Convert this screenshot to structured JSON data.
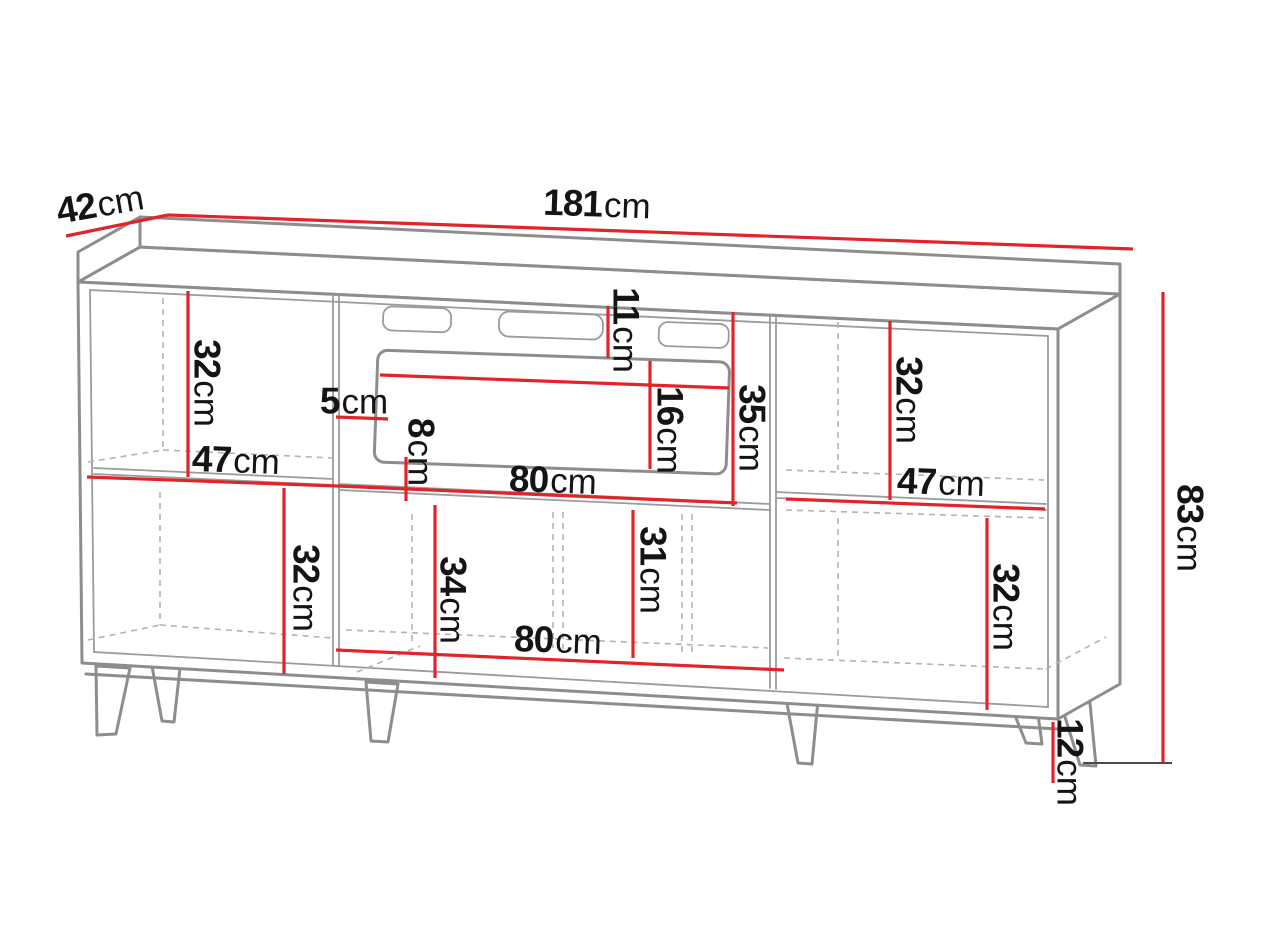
{
  "diagram": {
    "type": "furniture-dimension-drawing",
    "subject": "sideboard with fireplace niche and legs",
    "unit": "cm",
    "colors": {
      "dimension_line": "#e2242a",
      "outline": "#8d8d8d",
      "dashed": "#b3b3b3",
      "text": "#141414",
      "background": "#ffffff"
    },
    "dimensions": {
      "depth": {
        "value": "42",
        "unit": "cm"
      },
      "total_width": {
        "value": "181",
        "unit": "cm"
      },
      "total_height": {
        "value": "83",
        "unit": "cm"
      },
      "leg_height": {
        "value": "12",
        "unit": "cm"
      },
      "left_top_height": {
        "value": "32",
        "unit": "cm"
      },
      "left_width": {
        "value": "47",
        "unit": "cm"
      },
      "left_bottom_height": {
        "value": "32",
        "unit": "cm"
      },
      "vent_offset": {
        "value": "11",
        "unit": "cm"
      },
      "firebox_height": {
        "value": "16",
        "unit": "cm"
      },
      "niche_height": {
        "value": "35",
        "unit": "cm"
      },
      "side_gap": {
        "value": "5",
        "unit": "cm"
      },
      "bottom_gap": {
        "value": "8",
        "unit": "cm"
      },
      "niche_width": {
        "value": "80",
        "unit": "cm"
      },
      "middle_bottom_height": {
        "value": "34",
        "unit": "cm"
      },
      "middle_right_height": {
        "value": "31",
        "unit": "cm"
      },
      "bottom_niche_width": {
        "value": "80",
        "unit": "cm"
      },
      "right_top_height": {
        "value": "32",
        "unit": "cm"
      },
      "right_width": {
        "value": "47",
        "unit": "cm"
      },
      "right_bottom_height": {
        "value": "32",
        "unit": "cm"
      }
    }
  }
}
